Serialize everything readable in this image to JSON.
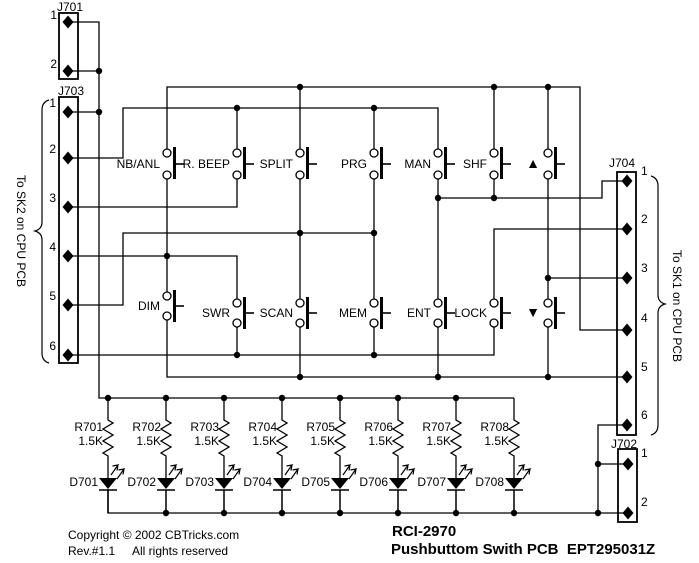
{
  "connectors": {
    "j701": {
      "label": "J701",
      "pins": [
        "1",
        "2"
      ]
    },
    "j703": {
      "label": "J703",
      "pins": [
        "1",
        "2",
        "3",
        "4",
        "5",
        "6"
      ],
      "note": "To SK2 on CPU PCB"
    },
    "j704": {
      "label": "J704",
      "pins": [
        "1",
        "2",
        "3",
        "4",
        "5",
        "6"
      ],
      "note": "To SK1 on CPU PCB"
    },
    "j702": {
      "label": "J702",
      "pins": [
        "1",
        "2"
      ]
    }
  },
  "buttons": {
    "top_row": [
      "NB/ANL",
      "R. BEEP",
      "SPLIT",
      "PRG",
      "MAN",
      "SHF",
      "▲"
    ],
    "bottom_row": [
      "DIM",
      "SWR",
      "SCAN",
      "MEM",
      "ENT",
      "LOCK",
      "▼"
    ]
  },
  "resistors": [
    {
      "ref": "R701",
      "value": "1.5K"
    },
    {
      "ref": "R702",
      "value": "1.5K"
    },
    {
      "ref": "R703",
      "value": "1.5K"
    },
    {
      "ref": "R704",
      "value": "1.5K"
    },
    {
      "ref": "R705",
      "value": "1.5K"
    },
    {
      "ref": "R706",
      "value": "1.5K"
    },
    {
      "ref": "R707",
      "value": "1.5K"
    },
    {
      "ref": "R708",
      "value": "1.5K"
    }
  ],
  "leds": [
    "D701",
    "D702",
    "D703",
    "D704",
    "D705",
    "D706",
    "D707",
    "D708"
  ],
  "footer": {
    "copyright": "Copyright © 2002 CBTricks.com",
    "rev": "Rev.#1.1",
    "rights": "All rights reserved",
    "model": "RCI-2970",
    "title": "Pushbuttom Swith PCB  EPT295031Z"
  },
  "colors": {
    "ink": "#000000",
    "paper": "#ffffff"
  }
}
